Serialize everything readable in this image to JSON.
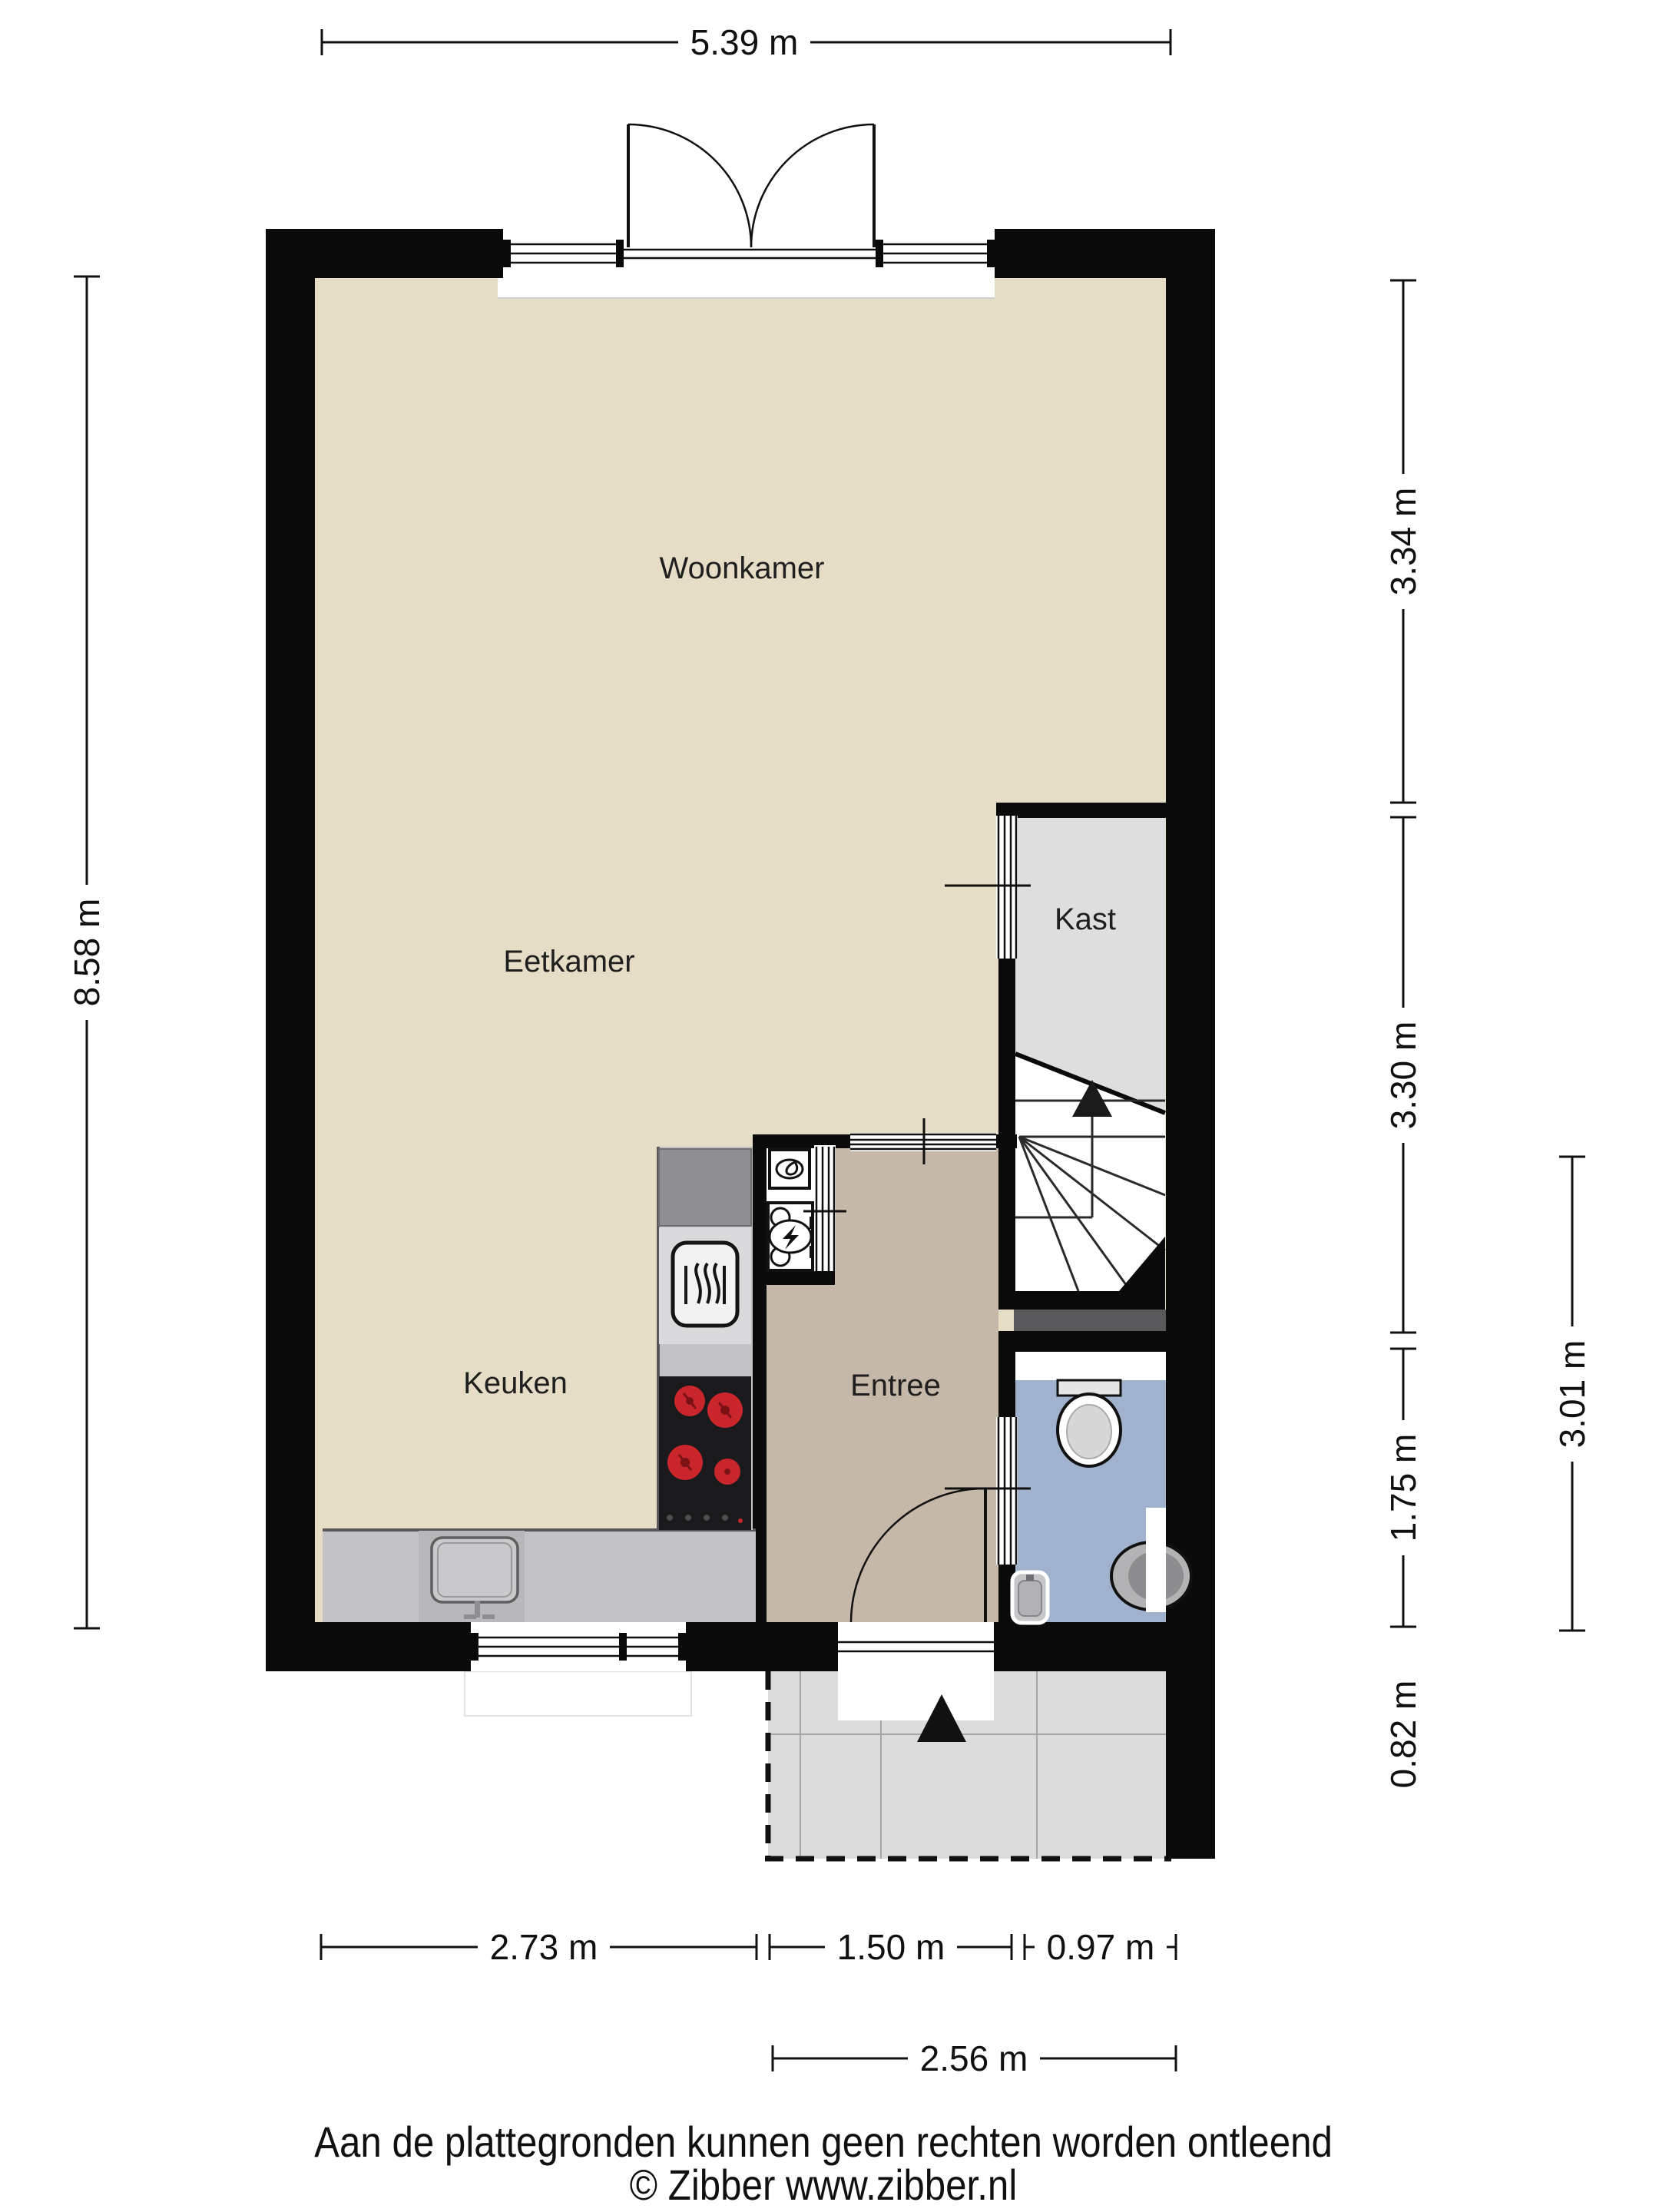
{
  "labels": {
    "woonkamer": "Woonkamer",
    "eetkamer": "Eetkamer",
    "keuken": "Keuken",
    "kast": "Kast",
    "entree": "Entree"
  },
  "dimensions": {
    "top": "5.39 m",
    "left": "8.58 m",
    "right_top": "3.34 m",
    "right_mid": "3.30 m",
    "right_low": "1.75 m",
    "right_bottom": "0.82 m",
    "right_outer": "3.01 m",
    "bottom_left": "2.73 m",
    "bottom_mid": "1.50 m",
    "bottom_right": "0.97 m",
    "bottom_total": "2.56 m"
  },
  "footer": {
    "disclaimer": "Aan de plattegronden kunnen geen rechten worden ontleend",
    "credit": "© Zibber www.zibber.nl"
  },
  "colors": {
    "wall": "#0a0a0a",
    "floor_living": "#e5ddc5",
    "floor_entree": "#c6b8a9",
    "floor_kast": "#dedede",
    "floor_toilet": "#a0b2ce",
    "floor_porch": "#dcdcdc",
    "counter": "#c3c3c5",
    "fridge": "#8f8f91",
    "cooktop": "#1a1a1c",
    "burner": "#c8262c",
    "niche": "#59595b"
  },
  "fixtures": [
    "french-doors",
    "window",
    "kitchen-counter",
    "fridge",
    "oven-icon",
    "cooktop-icon",
    "kitchen-sink",
    "meter-cupboard",
    "boiler-icon",
    "electric-meter-icon",
    "stairs-winder",
    "stairs-up-arrow",
    "toilet-icon",
    "corner-sink-icon",
    "hand-basin-icon",
    "entrance-door",
    "porch-tiles",
    "entrance-arrow"
  ]
}
